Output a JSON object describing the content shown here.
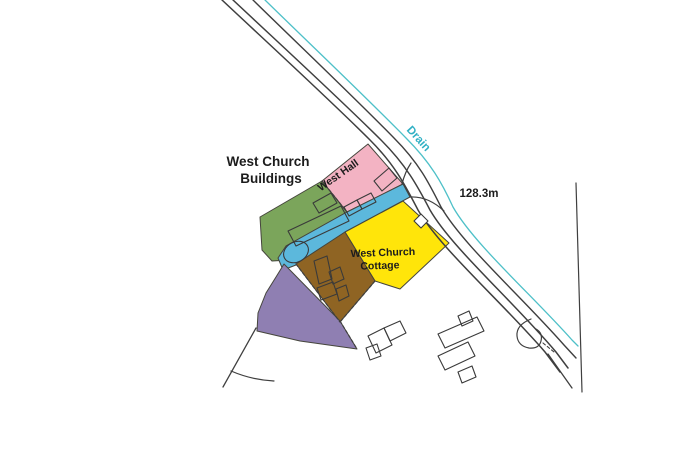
{
  "canvas": {
    "w": 700,
    "h": 467,
    "bg": "#ffffff"
  },
  "palette": {
    "pink": "#f3b3c3",
    "green": "#7ba55b",
    "blue_strip": "#5cb8dc",
    "yellow": "#ffe50a",
    "brown": "#8f6423",
    "purple": "#8f7fb2",
    "road_line": "#3f3f3f",
    "drain_line": "#4ec0c8",
    "drain_text": "#2fb0c4",
    "text": "#1c1c1c",
    "building_line": "#3a3a3a",
    "region_edge": "#45453c"
  },
  "labels": [
    {
      "name": "label-west-church-buildings-line1",
      "text": "West Church",
      "x": 268,
      "y": 166,
      "rotate": 0,
      "size": 13.5,
      "weight": 700,
      "color": "text"
    },
    {
      "name": "label-west-church-buildings-line2",
      "text": "Buildings",
      "x": 271,
      "y": 183,
      "rotate": 0,
      "size": 13.5,
      "weight": 700,
      "color": "text"
    },
    {
      "name": "label-west-hall",
      "text": "West Hall",
      "x": 340,
      "y": 178,
      "rotate": -35,
      "size": 10.5,
      "weight": 700,
      "color": "text"
    },
    {
      "name": "label-west-church-cottage-line1",
      "text": "West Church",
      "x": 383,
      "y": 256,
      "rotate": -2,
      "size": 10.5,
      "weight": 700,
      "color": "text"
    },
    {
      "name": "label-west-church-cottage-line2",
      "text": "Cottage",
      "x": 380,
      "y": 269,
      "rotate": -2,
      "size": 10.5,
      "weight": 700,
      "color": "text"
    },
    {
      "name": "label-drain",
      "text": "Drain",
      "x": 416,
      "y": 141,
      "rotate": 48,
      "size": 11.5,
      "weight": 600,
      "color": "drain_text"
    },
    {
      "name": "label-distance-128-3m",
      "text": "128.3m",
      "x": 479,
      "y": 197,
      "rotate": 0,
      "size": 11.5,
      "weight": 700,
      "color": "text"
    }
  ],
  "regions": [
    {
      "name": "region-green-west-church-buildings",
      "fill": "green",
      "points": "322,181 347,212 286,246 290,260 272,261 262,250 260,217"
    },
    {
      "name": "region-pink-west-hall",
      "fill": "pink",
      "points": "322,181 368,144 403,184 347,212"
    },
    {
      "name": "region-blue-strip",
      "fill": "blue_strip",
      "points": "403,184 410,197 345,232 296,265 283,270 278,258 286,246 347,212"
    },
    {
      "name": "region-yellow-west-church-cottage",
      "fill": "yellow",
      "points": "403,201 449,243 400,289 375,281 345,232"
    },
    {
      "name": "region-brown",
      "fill": "brown",
      "points": "345,232 375,281 340,322 296,264"
    },
    {
      "name": "region-purple",
      "fill": "purple",
      "points": "284,264 340,321 357,349 300,341 257,331 258,313 266,293 276,277"
    }
  ],
  "lines": [
    {
      "name": "road-edge-outer",
      "d": "M222,0 C270,45 330,100 370,140 C395,165 405,185 418,210 C440,248 500,300 545,352 L560,372",
      "color": "road_line",
      "width": 1.5
    },
    {
      "name": "road-edge-inner",
      "d": "M233,0 C281,45 341,100 381,140 C406,165 417,185 430,210 C452,248 512,300 556,352 L568,368",
      "color": "road_line",
      "width": 1.5
    },
    {
      "name": "road-edge-third",
      "d": "M253,0 C299,45 357,100 394,138 C419,163 429,183 441,207 C463,245 520,295 564,345 L576,358",
      "color": "road_line",
      "width": 1.4
    },
    {
      "name": "drain-line",
      "d": "M265,0 C311,45 369,100 406,138 C431,163 442,183 453,207 C474,244 532,295 572,340 L578,346",
      "color": "drain_line",
      "width": 1.3
    },
    {
      "name": "boundary-right-edge",
      "d": "M576,183 L582,392",
      "color": "road_line",
      "width": 1.2
    },
    {
      "name": "road-fork-end",
      "d": "M548,354 L572,388",
      "color": "road_line",
      "width": 1.3
    },
    {
      "name": "boundary-southwest",
      "d": "M256,328 L223,387",
      "color": "road_line",
      "width": 1.3
    },
    {
      "name": "boundary-southwest-curve",
      "d": "M231,371 Q252,380 274,381",
      "color": "road_line",
      "width": 1.2
    },
    {
      "name": "entrance-curve-north",
      "d": "M402,184 Q405,172 411,163",
      "color": "road_line",
      "width": 1.2
    },
    {
      "name": "entrance-curve-south",
      "d": "M410,197 Q428,196 444,211",
      "color": "road_line",
      "width": 1.2
    },
    {
      "name": "dashed-green-pink-boundary",
      "d": "M322,181 L347,212",
      "color": "road_line",
      "width": 1.2,
      "dash": "3,2.5"
    },
    {
      "name": "dashed-brown-purple-boundary",
      "d": "M296,264 L340,322",
      "color": "road_line",
      "width": 1.2,
      "dash": "3,2.5"
    },
    {
      "name": "dashed-brown-southeast-edge",
      "d": "M375,281 L340,322",
      "color": "road_line",
      "width": 1.2,
      "dash": "3,2.5"
    },
    {
      "name": "dashed-purple-northeast-edge",
      "d": "M340,321 L357,349",
      "color": "road_line",
      "width": 1.2,
      "dash": "3,2.5"
    },
    {
      "name": "driveway-outline",
      "d": "M531,319 Q516,325 517,336 Q518,346 529,348 Q539,349 541,341 Q543,333 536,329",
      "color": "road_line",
      "width": 1.2
    },
    {
      "name": "driveway-dash",
      "d": "M543,343 L554,352",
      "color": "road_line",
      "width": 1.1,
      "dash": "3,2.5"
    }
  ],
  "buildings": [
    {
      "name": "building-green-main",
      "type": "poly",
      "points": "288,231 341,206 349,221 296,246",
      "fill": "none"
    },
    {
      "name": "building-green-upper",
      "type": "poly",
      "points": "313,203 331,193 337,203 319,213",
      "fill": "none"
    },
    {
      "name": "building-green-round",
      "type": "ellipse",
      "cx": 296,
      "cy": 252,
      "rx": 13,
      "ry": 10,
      "rotate": -28,
      "fill": "none"
    },
    {
      "name": "building-pink-square-1",
      "type": "poly",
      "points": "344,207 357,200 362,209 349,216",
      "fill": "none"
    },
    {
      "name": "building-pink-square-2",
      "type": "poly",
      "points": "357,200 371,193 376,202 362,209",
      "fill": "none"
    },
    {
      "name": "building-pink-large",
      "type": "poly",
      "points": "374,181 389,168 397,178 382,191",
      "fill": "none"
    },
    {
      "name": "building-yellow-square",
      "type": "poly",
      "points": "414,221 421,214 428,221 421,228",
      "fill": "#ffffff"
    },
    {
      "name": "building-brown-1",
      "type": "poly",
      "points": "314,261 327,256 332,279 319,284",
      "fill": "none"
    },
    {
      "name": "building-brown-2",
      "type": "poly",
      "points": "329,272 340,267 344,279 333,284",
      "fill": "none"
    },
    {
      "name": "building-brown-3",
      "type": "poly",
      "points": "317,288 333,282 337,294 321,300",
      "fill": "none"
    },
    {
      "name": "building-brown-4",
      "type": "poly",
      "points": "336,289 346,285 349,296 339,301",
      "fill": "none"
    },
    {
      "name": "building-south-a1",
      "type": "poly",
      "points": "368,336 384,328 392,345 376,353",
      "fill": "none"
    },
    {
      "name": "building-south-a2",
      "type": "poly",
      "points": "384,328 400,321 406,333 390,341",
      "fill": "none"
    },
    {
      "name": "building-south-a3",
      "type": "poly",
      "points": "366,348 377,344 381,356 370,360",
      "fill": "none"
    },
    {
      "name": "building-south-b1",
      "type": "poly",
      "points": "438,334 477,317 484,331 445,348",
      "fill": "none"
    },
    {
      "name": "building-south-b2",
      "type": "poly",
      "points": "458,316 469,311 473,321 462,326",
      "fill": "none"
    },
    {
      "name": "building-south-b3",
      "type": "poly",
      "points": "438,356 468,342 475,356 445,370",
      "fill": "none"
    },
    {
      "name": "building-south-b4",
      "type": "poly",
      "points": "458,372 472,366 476,377 462,383",
      "fill": "none"
    }
  ]
}
